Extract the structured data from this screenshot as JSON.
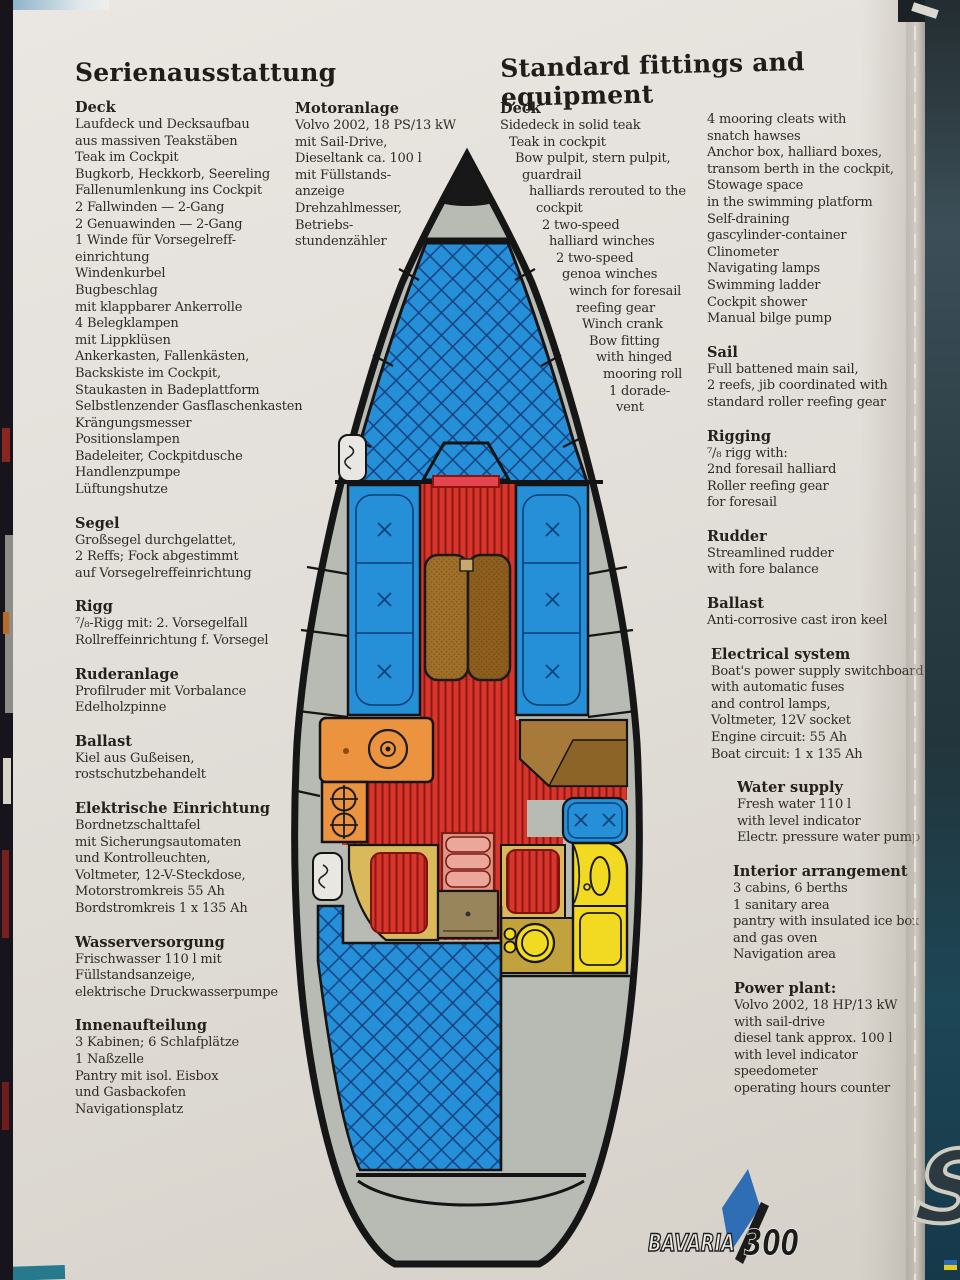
{
  "page": {
    "title_de": "Serienausstattung",
    "title_en": "Standard fittings and equipment"
  },
  "german": {
    "deck": {
      "heading": "Deck",
      "lines": [
        "Laufdeck und Decksaufbau",
        "aus massiven Teakstäben",
        "Teak im Cockpit",
        "Bugkorb, Heckkorb, Seereling",
        "Fallenumlenkung ins Cockpit",
        "2 Fallwinden — 2-Gang",
        "2 Genuawinden — 2-Gang",
        "1 Winde für Vorsegelreff-",
        "einrichtung",
        "Windenkurbel",
        "Bugbeschlag",
        "mit klappbarer Ankerrolle",
        "4 Belegklampen",
        "mit Lippklüsen",
        "Ankerkasten, Fallenkästen,",
        "Backskiste im Cockpit,",
        "Staukasten in Badeplattform",
        "Selbstlenzender Gasflaschenkasten",
        "Krängungsmesser",
        "Positionslampen",
        "Badeleiter, Cockpitdusche",
        "Handlenzpumpe",
        "Lüftungshutze"
      ]
    },
    "segel": {
      "heading": "Segel",
      "lines": [
        "Großsegel durchgelattet,",
        "2 Reffs; Fock abgestimmt",
        "auf Vorsegelreffeinrichtung"
      ]
    },
    "rigg": {
      "heading": "Rigg",
      "lines": [
        "⁷/₈-Rigg mit: 2. Vorsegelfall",
        "Rollreffeinrichtung f. Vorsegel"
      ]
    },
    "ruderanlage": {
      "heading": "Ruderanlage",
      "lines": [
        "Profilruder mit Vorbalance",
        "Edelholzpinne"
      ]
    },
    "ballast": {
      "heading": "Ballast",
      "lines": [
        "Kiel aus Gußeisen,",
        "rostschutzbehandelt"
      ]
    },
    "elektrische": {
      "heading": "Elektrische Einrichtung",
      "lines": [
        "Bordnetzschalttafel",
        "mit Sicherungsautomaten",
        "und Kontrolleuchten,",
        "Voltmeter, 12-V-Steckdose,",
        "Motorstromkreis 55 Ah",
        "Bordstromkreis 1 x 135 Ah"
      ]
    },
    "wasser": {
      "heading": "Wasserversorgung",
      "lines": [
        "Frischwasser 110 l mit",
        "Füllstandsanzeige,",
        "elektrische Druckwasserpumpe"
      ]
    },
    "innen": {
      "heading": "Innenaufteilung",
      "lines": [
        "3 Kabinen; 6 Schlafplätze",
        "1 Naßzelle",
        "Pantry mit isol. Eisbox",
        "und Gasbackofen",
        "Navigationsplatz"
      ]
    },
    "motor": {
      "heading": "Motoranlage",
      "lines": [
        "Volvo 2002, 18 PS/13 kW",
        "mit Sail-Drive,",
        "Dieseltank ca. 100 l",
        "mit Füllstands-",
        "anzeige",
        "Drehzahlmesser,",
        "Betriebs-",
        "stundenzähler"
      ]
    }
  },
  "english": {
    "deck": {
      "heading": "Deck",
      "lines": [
        "Sidedeck in solid teak",
        "Teak in cockpit",
        "Bow pulpit, stern pulpit,",
        "guardrail",
        "halliards rerouted to the",
        "cockpit",
        "2 two-speed",
        "halliard winches",
        "2 two-speed",
        "genoa winches",
        "winch for foresail",
        "reefing gear",
        "Winch crank",
        "Bow fitting",
        "with hinged",
        "mooring roll",
        "1 dorade-",
        "vent"
      ]
    },
    "deck_right": {
      "lines": [
        "4 mooring cleats with",
        "snatch  hawses",
        "Anchor box, halliard boxes,",
        "transom berth in the cockpit,",
        "Stowage space",
        "in the swimming platform",
        "Self-draining",
        "gascylinder-container",
        "Clinometer",
        "Navigating lamps",
        "Swimming ladder",
        "Cockpit shower",
        "Manual bilge pump"
      ]
    },
    "sail": {
      "heading": "Sail",
      "lines": [
        "Full battened main sail,",
        "2 reefs, jib coordinated with",
        "standard roller reefing gear"
      ]
    },
    "rigging": {
      "heading": "Rigging",
      "lines": [
        "⁷/₈ rigg with:",
        "2nd foresail halliard",
        "Roller reefing gear",
        "for foresail"
      ]
    },
    "rudder": {
      "heading": "Rudder",
      "lines": [
        "Streamlined rudder",
        "with fore balance"
      ]
    },
    "ballast": {
      "heading": "Ballast",
      "lines": [
        "Anti-corrosive cast iron keel"
      ]
    },
    "electrical": {
      "heading": "Electrical system",
      "lines": [
        "Boat's power supply switchboard",
        "with automatic fuses",
        "and control lamps,",
        "Voltmeter, 12V socket",
        "Engine circuit: 55 Ah",
        "Boat circuit: 1 x 135 Ah"
      ]
    },
    "water": {
      "heading": "Water supply",
      "lines": [
        "Fresh water  110 l",
        "with level indicator",
        "Electr. pressure water pump"
      ]
    },
    "interior": {
      "heading": "Interior arrangement",
      "lines": [
        "3 cabins, 6 berths",
        "1 sanitary area",
        "pantry with insulated ice box",
        "and gas oven",
        "Navigation area"
      ]
    },
    "power": {
      "heading": "Power plant:",
      "lines": [
        "Volvo 2002, 18 HP/13 kW",
        "with sail-drive",
        "diesel tank approx. 100 l",
        "with level indicator",
        "speedometer",
        "operating hours counter"
      ]
    }
  },
  "logo": {
    "brand": "BAVARIA",
    "model": "300"
  },
  "adjacent_page_letter": "S",
  "illustration": {
    "type": "sailboat-deck-plan",
    "areas": [
      "bow-fitting",
      "foredeck",
      "forward-hatch",
      "saloon-settees",
      "saloon-table",
      "companionway",
      "galley-sink",
      "stove",
      "chart-table",
      "navigation-seat",
      "head-compartment",
      "toilet",
      "aft-berths",
      "companionway-steps",
      "engine-box",
      "cockpit",
      "swimming-platform"
    ]
  },
  "colors": {
    "deck_blue": "#2590d8",
    "sole_red": "#d7362c",
    "galley_orange": "#ec9340",
    "head_yellow": "#f2da22",
    "berth_tan": "#d9b95c",
    "table_brown": "#9a6a26",
    "deck_gray": "#b8bbb3",
    "logo_blue": "#2f6db5"
  }
}
